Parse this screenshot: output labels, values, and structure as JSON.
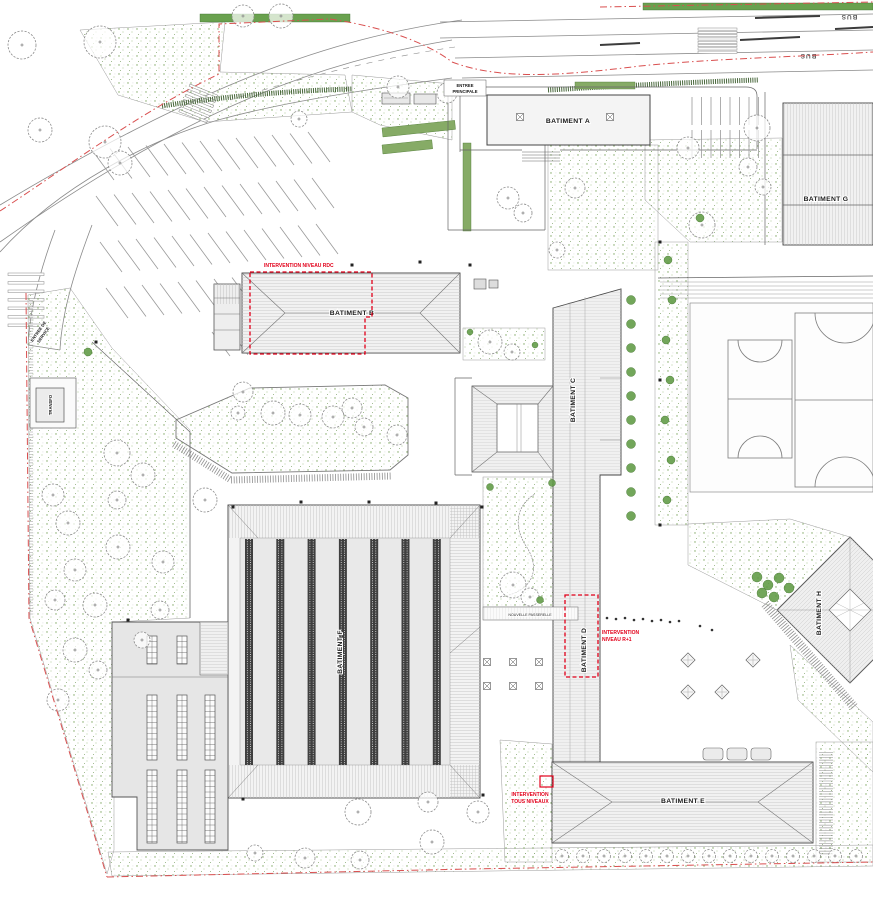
{
  "plan": {
    "buildings": {
      "a": "BATIMENT A",
      "b": "BATIMENT B",
      "c": "BATIMENT C",
      "d": "BATIMENT D",
      "e": "BATIMENT E",
      "f": "BATIMENT F",
      "g": "BATIMENT G",
      "h": "BATIMENT H"
    },
    "labels": {
      "entree_principale_1": "ENTREE",
      "entree_principale_2": "PRINCIPALE",
      "entree_service_1": "ENTREE DE",
      "entree_service_2": "SERVICE",
      "transfo": "TRANSFO",
      "passerelle": "NOUVELLE PASSERELLE",
      "bus": "BUS"
    },
    "annotations": {
      "rdc": "INTERVENTION NIVEAU RDC",
      "r1_1": "INTERVENTION",
      "r1_2": "NIVEAU R+1",
      "tous_1": "INTERVENTION",
      "tous_2": "TOUS NIVEAUX"
    },
    "colors": {
      "annotation_red": "#e2001a",
      "boundary_red": "#d94f4f",
      "vegetation_green": "#5f9a43",
      "hedge_green": "#69a14e",
      "building_fill": "#f1f1f1",
      "line_gray": "#555555"
    }
  },
  "collections": {
    "trees": [
      [
        22,
        45,
        14
      ],
      [
        100,
        42,
        16
      ],
      [
        243,
        16,
        11
      ],
      [
        281,
        16,
        12
      ],
      [
        40,
        130,
        12
      ],
      [
        105,
        142,
        16
      ],
      [
        120,
        163,
        12
      ],
      [
        299,
        119,
        8
      ],
      [
        398,
        87,
        11
      ],
      [
        447,
        93,
        10
      ],
      [
        508,
        198,
        11
      ],
      [
        523,
        213,
        9
      ],
      [
        575,
        188,
        10
      ],
      [
        557,
        250,
        8
      ],
      [
        688,
        148,
        11
      ],
      [
        757,
        128,
        13
      ],
      [
        748,
        167,
        9
      ],
      [
        702,
        225,
        13
      ],
      [
        763,
        187,
        8
      ],
      [
        490,
        342,
        12
      ],
      [
        512,
        352,
        8
      ],
      [
        243,
        392,
        10
      ],
      [
        273,
        413,
        12
      ],
      [
        300,
        415,
        11
      ],
      [
        333,
        417,
        11
      ],
      [
        352,
        408,
        10
      ],
      [
        364,
        427,
        9
      ],
      [
        397,
        435,
        10
      ],
      [
        238,
        413,
        7
      ],
      [
        117,
        453,
        13
      ],
      [
        143,
        475,
        12
      ],
      [
        53,
        495,
        11
      ],
      [
        68,
        523,
        12
      ],
      [
        117,
        500,
        9
      ],
      [
        205,
        500,
        12
      ],
      [
        118,
        547,
        12
      ],
      [
        75,
        570,
        11
      ],
      [
        163,
        562,
        11
      ],
      [
        55,
        600,
        10
      ],
      [
        95,
        605,
        12
      ],
      [
        160,
        610,
        9
      ],
      [
        75,
        650,
        12
      ],
      [
        58,
        700,
        11
      ],
      [
        98,
        670,
        9
      ],
      [
        142,
        640,
        8
      ],
      [
        358,
        812,
        13
      ],
      [
        428,
        802,
        10
      ],
      [
        432,
        842,
        12
      ],
      [
        305,
        858,
        10
      ],
      [
        360,
        860,
        9
      ],
      [
        255,
        853,
        8
      ],
      [
        478,
        812,
        11
      ],
      [
        513,
        585,
        13
      ],
      [
        530,
        597,
        9
      ],
      [
        562,
        856,
        6.5
      ],
      [
        583,
        856,
        6.5
      ],
      [
        604,
        856,
        6.5
      ],
      [
        625,
        856,
        6.5
      ],
      [
        646,
        856,
        6.5
      ],
      [
        667,
        856,
        6.5
      ],
      [
        688,
        856,
        6.5
      ],
      [
        709,
        856,
        6.5
      ],
      [
        730,
        856,
        6.5
      ],
      [
        751,
        856,
        6.5
      ],
      [
        772,
        856,
        6.5
      ],
      [
        793,
        856,
        6.5
      ],
      [
        814,
        856,
        6.5
      ],
      [
        835,
        856,
        6.5
      ],
      [
        856,
        856,
        6.5
      ]
    ],
    "shrubs": [
      [
        631,
        300,
        4.5
      ],
      [
        631,
        324,
        4.5
      ],
      [
        631,
        348,
        4.5
      ],
      [
        631,
        372,
        4.5
      ],
      [
        631,
        396,
        4.5
      ],
      [
        631,
        420,
        4.5
      ],
      [
        631,
        444,
        4.5
      ],
      [
        631,
        468,
        4.5
      ],
      [
        631,
        492,
        4.5
      ],
      [
        631,
        516,
        4.5
      ],
      [
        668,
        260,
        4
      ],
      [
        672,
        300,
        4
      ],
      [
        666,
        340,
        4
      ],
      [
        670,
        380,
        4
      ],
      [
        665,
        420,
        4
      ],
      [
        671,
        460,
        4
      ],
      [
        667,
        500,
        4
      ],
      [
        757,
        577,
        5
      ],
      [
        768,
        585,
        5
      ],
      [
        779,
        578,
        5
      ],
      [
        789,
        588,
        5
      ],
      [
        762,
        593,
        5
      ],
      [
        774,
        597,
        5
      ],
      [
        490,
        487,
        3.5
      ],
      [
        552,
        483,
        3.5
      ],
      [
        540,
        600,
        3.5
      ],
      [
        700,
        218,
        4
      ],
      [
        88,
        352,
        4
      ],
      [
        470,
        332,
        3
      ],
      [
        535,
        345,
        3
      ]
    ],
    "parking_rows": [
      {
        "x": 92,
        "y": 150,
        "n": 13,
        "sx": 18,
        "sy": -1.5,
        "dx": 22,
        "dy": 30
      },
      {
        "x": 96,
        "y": 196,
        "n": 13,
        "sx": 18,
        "sy": -1.5,
        "dx": 22,
        "dy": 30
      },
      {
        "x": 100,
        "y": 242,
        "n": 13,
        "sx": 18,
        "sy": -1.5,
        "dx": 22,
        "dy": 30
      },
      {
        "x": 106,
        "y": 288,
        "n": 12,
        "sx": 18,
        "sy": -1.5,
        "dx": 22,
        "dy": 30
      },
      {
        "x": 212,
        "y": 332,
        "n": 6,
        "sx": 18,
        "sy": -1.2,
        "dx": 18,
        "dy": 24
      },
      {
        "x": 692,
        "y": 97,
        "n": 8,
        "sx": 9.5,
        "sy": 0,
        "dx": 0,
        "dy": 28
      },
      {
        "x": 692,
        "y": 130,
        "n": 8,
        "sx": 9.5,
        "sy": 0,
        "dx": 0,
        "dy": 28
      }
    ],
    "f_stripes": {
      "x0": 245,
      "step": 31.3,
      "n": 7,
      "y": 539,
      "h": 226,
      "w": 8
    },
    "annex_grids": [
      [
        147,
        636,
        10,
        28
      ],
      [
        177,
        636,
        10,
        28
      ],
      [
        147,
        695,
        10,
        65
      ],
      [
        177,
        695,
        10,
        65
      ],
      [
        205,
        695,
        10,
        65
      ],
      [
        147,
        770,
        10,
        73
      ],
      [
        177,
        770,
        10,
        73
      ],
      [
        205,
        770,
        10,
        73
      ]
    ],
    "cross_marks": [
      [
        520,
        117
      ],
      [
        610,
        117
      ],
      [
        487,
        662
      ],
      [
        513,
        662
      ],
      [
        539,
        662
      ],
      [
        487,
        686
      ],
      [
        513,
        686
      ],
      [
        539,
        686
      ]
    ],
    "planters": [
      [
        688,
        660
      ],
      [
        688,
        692
      ],
      [
        722,
        692
      ],
      [
        753,
        660
      ]
    ],
    "trail_dots": [
      [
        607,
        618
      ],
      [
        616,
        619
      ],
      [
        625,
        618
      ],
      [
        634,
        620
      ],
      [
        643,
        619
      ],
      [
        652,
        621
      ],
      [
        661,
        620
      ],
      [
        670,
        622
      ],
      [
        679,
        621
      ],
      [
        700,
        626
      ],
      [
        712,
        630
      ]
    ],
    "black_marks": [
      [
        233,
        507
      ],
      [
        301,
        502
      ],
      [
        369,
        502
      ],
      [
        436,
        503
      ],
      [
        482,
        507
      ],
      [
        243,
        799
      ],
      [
        483,
        795
      ],
      [
        352,
        265
      ],
      [
        420,
        262
      ],
      [
        470,
        265
      ],
      [
        660,
        242
      ],
      [
        660,
        380
      ],
      [
        660,
        525
      ],
      [
        128,
        620
      ],
      [
        96,
        342
      ]
    ],
    "zebras": [
      {
        "x": 698,
        "y": 28,
        "w": 39,
        "bh": 2.2,
        "n": 8,
        "gap": 3.3,
        "rot": 0
      },
      {
        "x": 8,
        "y": 273,
        "w": 36,
        "bh": 2.6,
        "n": 7,
        "gap": 8.5,
        "rot": 0
      },
      {
        "x": 190,
        "y": 84,
        "w": 30,
        "bh": 2.4,
        "n": 6,
        "gap": 5.5,
        "rot": 22
      }
    ]
  }
}
